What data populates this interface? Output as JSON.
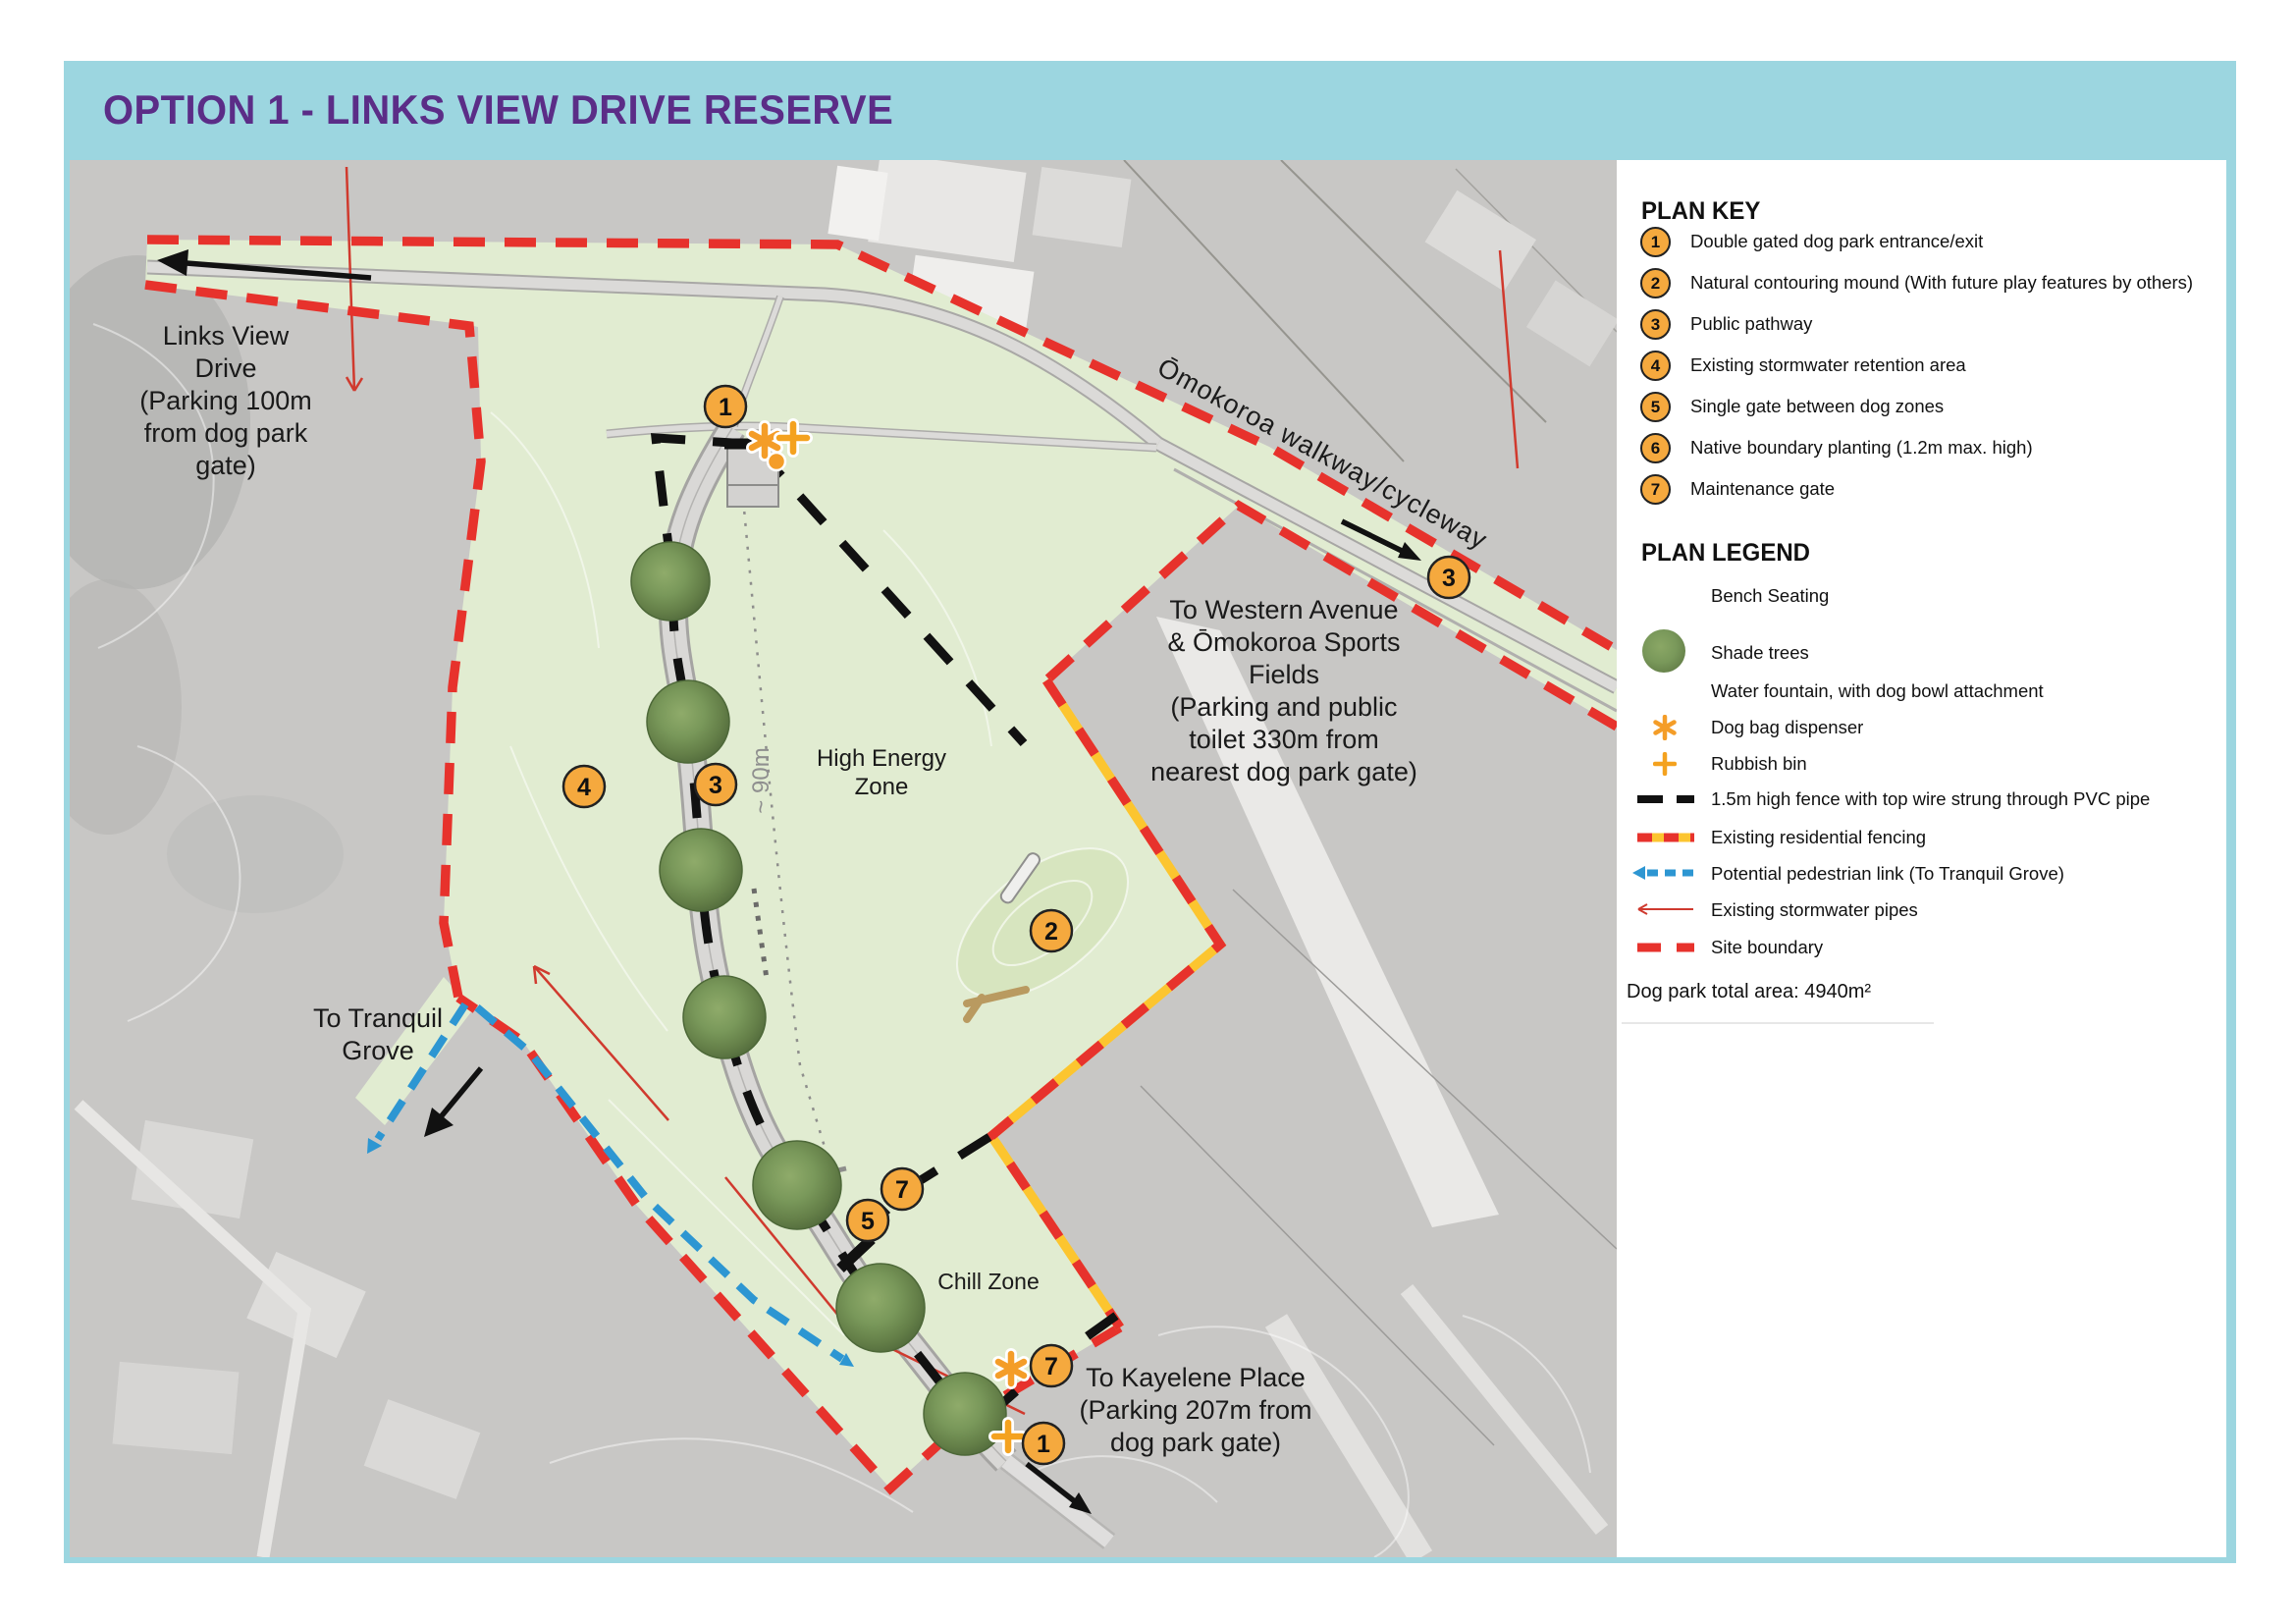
{
  "title": "OPTION 1 - LINKS VIEW DRIVE RESERVE",
  "colors": {
    "frame_blue": "#9cd6e0",
    "title_purple": "#5b2d87",
    "marker_orange": "#f5a93e",
    "icon_orange": "#f49d28",
    "boundary_red": "#e7322c",
    "fence_yellow": "#fcc52f",
    "link_blue": "#2d96d2",
    "park_green": "#e1ecd1"
  },
  "plan_key": {
    "title": "PLAN KEY",
    "items": [
      {
        "number": "1",
        "label": "Double gated dog park entrance/exit"
      },
      {
        "number": "2",
        "label": "Natural contouring mound (With future play features by others)"
      },
      {
        "number": "3",
        "label": "Public pathway"
      },
      {
        "number": "4",
        "label": "Existing stormwater retention area"
      },
      {
        "number": "5",
        "label": "Single gate between dog zones"
      },
      {
        "number": "6",
        "label": "Native boundary planting (1.2m max. high)"
      },
      {
        "number": "7",
        "label": "Maintenance gate"
      }
    ]
  },
  "plan_legend": {
    "title": "PLAN LEGEND",
    "items": [
      {
        "label": "Bench Seating",
        "swatch": "bench-seating"
      },
      {
        "label": "Shade trees",
        "swatch": "shade-trees"
      },
      {
        "label": "Water fountain, with dog bowl attachment",
        "swatch": "water-fountain"
      },
      {
        "label": "Dog bag dispenser",
        "swatch": "dog-bag-dispenser"
      },
      {
        "label": "Rubbish bin",
        "swatch": "rubbish-bin"
      },
      {
        "label": "1.5m high fence with top wire strung through PVC pipe",
        "swatch": "fence"
      },
      {
        "label": "Existing residential fencing",
        "swatch": "residential-fencing"
      },
      {
        "label": "Potential pedestrian link (To Tranquil Grove)",
        "swatch": "pedestrian-link"
      },
      {
        "label": "Existing stormwater pipes",
        "swatch": "stormwater-pipes"
      },
      {
        "label": "Site boundary",
        "swatch": "site-boundary"
      }
    ],
    "total_area": "Dog park total area: 4940m²"
  },
  "map": {
    "labels": {
      "links_view": "Links View\nDrive\n(Parking 100m\nfrom dog park\ngate)",
      "walkway": "Ōmokoroa walkway/cycleway",
      "western": "To Western Avenue\n& Ōmokoroa Sports\nFields\n(Parking and public\ntoilet 330m from\nnearest dog park gate)",
      "tranquil": "To Tranquil\nGrove",
      "kayelene": "To Kayelene Place\n(Parking 207m from\ndog park gate)",
      "high_energy": "High Energy\nZone",
      "chill": "Chill Zone",
      "distance": "~ 90m"
    },
    "markers": [
      {
        "number": "1",
        "name": "north-entrance"
      },
      {
        "number": "3",
        "name": "central-pathway"
      },
      {
        "number": "4",
        "name": "stormwater-retention-area"
      },
      {
        "number": "2",
        "name": "contouring-mound"
      },
      {
        "number": "3",
        "name": "walkway-pathway"
      },
      {
        "number": "7",
        "name": "mid-maintenance-gate"
      },
      {
        "number": "5",
        "name": "zone-gate"
      },
      {
        "number": "7",
        "name": "south-maintenance-gate"
      },
      {
        "number": "1",
        "name": "south-entrance"
      }
    ]
  }
}
